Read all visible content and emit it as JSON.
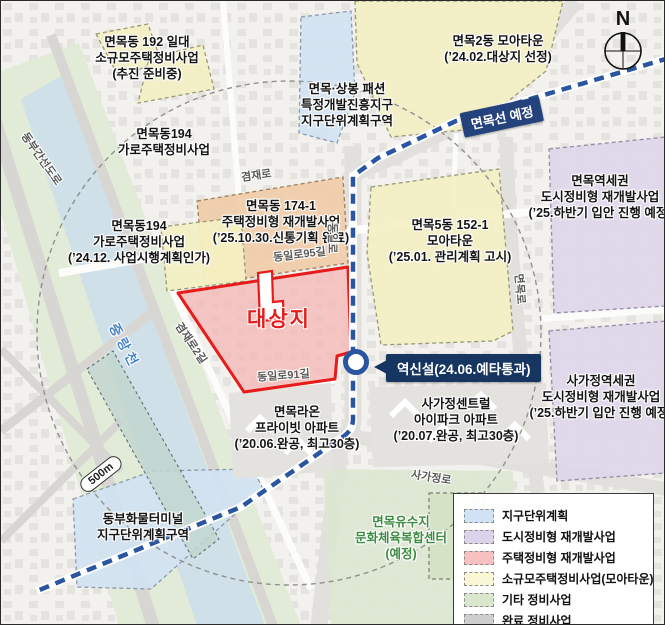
{
  "map": {
    "compass_label": "N",
    "scale_label": "500m",
    "river_label": "중랑천",
    "target_label": "대상지",
    "colors": {
      "target_red": "#e81b1b",
      "subway_line_blue": "#2a55a0",
      "line_badge_navy": "#24427c",
      "station_badge_navy": "#163561",
      "planned_green_text": "#3d8b40"
    },
    "transit": {
      "line_badge": "면목선 예정",
      "station_badge": "역신설(24.06.예타통과)"
    },
    "roads": {
      "gyeomjae": "겸재로",
      "gyeomjae2": "겸재로2길",
      "dongil": "동일로",
      "dongil95": "동일로95길",
      "dongil91": "동일로91길",
      "myeonmok": "면목로",
      "sagajeong": "사가정로",
      "dongbu": "동부간선도로"
    },
    "zones": {
      "m192": {
        "lines": [
          "면목동 192 일대",
          "소규모주택정비사업",
          "(추진 준비중)"
        ]
      },
      "m194a": {
        "lines": [
          "면목동194",
          "가로주택정비사업"
        ]
      },
      "fashion": {
        "lines": [
          "면목·상봉 패션",
          "특정개발진흥지구",
          "지구단위계획구역"
        ]
      },
      "m2dong": {
        "lines": [
          "면목2동 모아타운",
          "(’24.02.대상지 선정)"
        ]
      },
      "m174": {
        "lines": [
          "면목동 174-1",
          "주택정비형 재개발사업",
          "(’25.10.30.신통기획 완료)"
        ]
      },
      "m194b": {
        "lines": [
          "면목동194",
          "가로주택정비사업",
          "(’24.12. 사업시행계획인가)"
        ]
      },
      "m5dong": {
        "lines": [
          "면목5동 152-1",
          "모아타운",
          "(’25.01. 관리계획 고시)"
        ]
      },
      "mstation": {
        "lines": [
          "면목역세권",
          "도시정비형 재개발사업",
          "(’25.하반기 입안 진행 예정)"
        ]
      },
      "sstation": {
        "lines": [
          "사가정역세권",
          "도시정비형 재개발사업",
          "(’25.하반기 입안 진행 예정)"
        ]
      },
      "raon": {
        "lines": [
          "면목라온",
          "프라이빗 아파트",
          "(’20.06.완공, 최고30층)"
        ]
      },
      "ipark": {
        "lines": [
          "사가정센트럴",
          "아이파크 아파트",
          "(’20.07.완공, 최고30층)"
        ]
      },
      "terminal": {
        "lines": [
          "동부화물터미널",
          "지구단위계획구역"
        ]
      },
      "yusuji": {
        "lines": [
          "면목유수지",
          "문화체육복합센터",
          "(예정)"
        ]
      }
    },
    "legend": {
      "items": [
        {
          "label": "지구단위계획",
          "color": "#cfe3f4"
        },
        {
          "label": "도시정비형 재개발사업",
          "color": "#dbd3ea"
        },
        {
          "label": "주택정비형 재개발사업",
          "color": "#f8c1c1"
        },
        {
          "label": "소규모주택정비사업(모아타운)",
          "color": "#faf7d4"
        },
        {
          "label": "기타 정비사업",
          "color": "#d9e7cd"
        },
        {
          "label": "완료 정비사업",
          "color": "#cfcfcf"
        }
      ]
    }
  }
}
